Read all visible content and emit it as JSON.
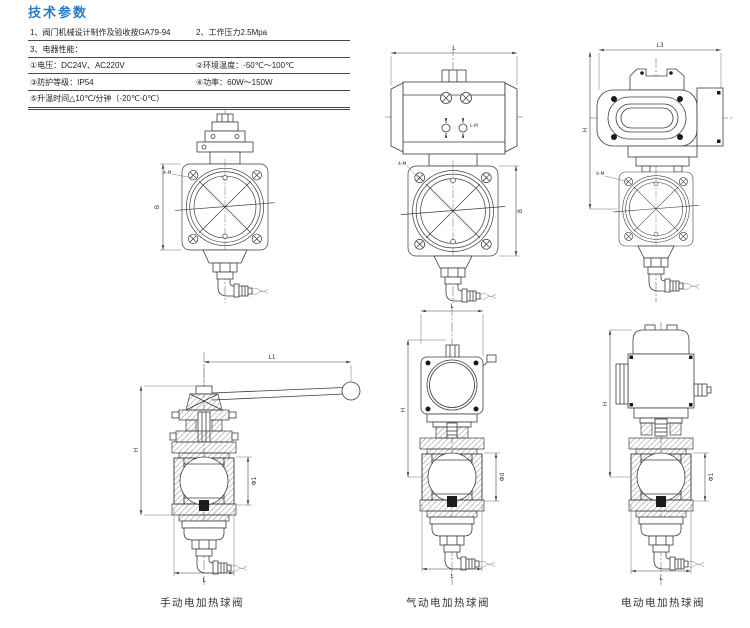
{
  "header": {
    "title": "技术参数"
  },
  "colors": {
    "accent": "#2b7cc4",
    "line": "#3c3c3c"
  },
  "specs": {
    "row1_left": "1、阀门机械设计制作及验收按GA79-94",
    "row1_right": "2、工作压力2.5Mpa",
    "row2_left": "3、电器性能：",
    "row3_left": "①电压：DC24V、AC220V",
    "row3_right": "②环境温度：-50℃～100℃",
    "row4_left": "③防护等级：IP54",
    "row4_right": "④功率：60W～150W",
    "row5_left": "⑤升温时间△10℃/分钟（-20℃-0℃）"
  },
  "captions": {
    "manual": "手动电加热球阀",
    "pneumatic": "气动电加热球阀",
    "electric": "电动电加热球阀"
  },
  "drawings": {
    "manual_top": {
      "dim_width": "B",
      "bolt_callout": "4-M"
    },
    "pneumatic_assembly": {
      "dim_length": "L",
      "dim_width": "B",
      "bolt_callout": "4-M",
      "port_label": "L-M"
    },
    "electric_assembly": {
      "dim_length": "L3",
      "dim_height": "H",
      "bolt_callout": "4-M"
    },
    "manual_section": {
      "dim_handle": "L1",
      "dim_height": "H",
      "dim_bore": "Φ1",
      "dim_length": "L"
    },
    "pneumatic_section": {
      "dim_length_top": "L",
      "dim_height": "H",
      "dim_bore": "Φd",
      "dim_length": "L"
    },
    "electric_section": {
      "dim_height": "H",
      "dim_bore": "Φ1",
      "dim_length": "L"
    }
  }
}
